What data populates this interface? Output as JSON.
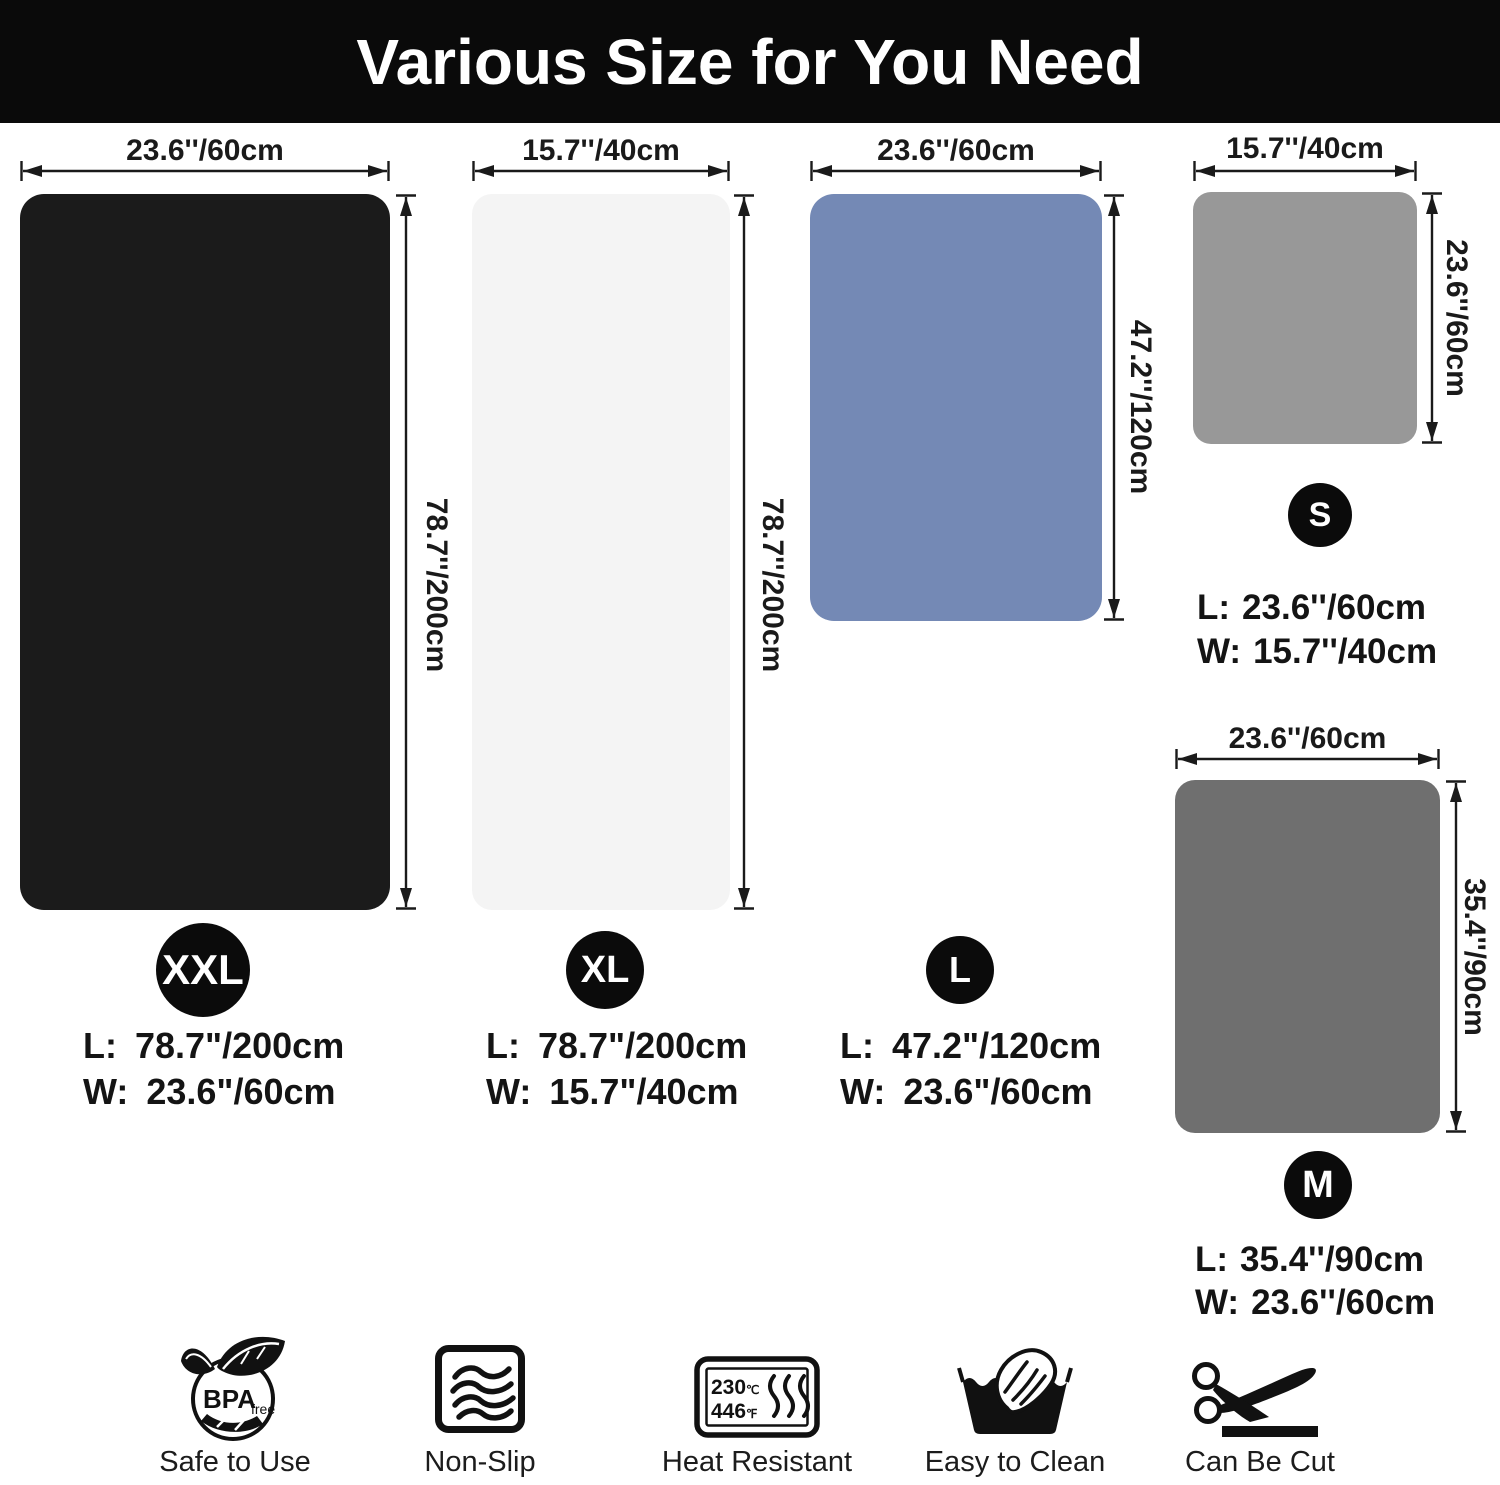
{
  "header": {
    "title": "Various Size for You Need"
  },
  "mats": {
    "xxl": {
      "badge": "XXL",
      "top_dim": "23.6''/60cm",
      "side_dim": "78.7''/200cm",
      "l_label": "L:",
      "l_value": "78.7\"/200cm",
      "w_label": "W:",
      "w_value": "23.6\"/60cm",
      "color": "#1b1b1b"
    },
    "xl": {
      "badge": "XL",
      "top_dim": "15.7''/40cm",
      "side_dim": "78.7''/200cm",
      "l_label": "L:",
      "l_value": "78.7\"/200cm",
      "w_label": "W:",
      "w_value": "15.7\"/40cm",
      "color": "#f4f4f4"
    },
    "l": {
      "badge": "L",
      "top_dim": "23.6''/60cm",
      "side_dim": "47.2''/120cm",
      "l_label": "L:",
      "l_value": "47.2\"/120cm",
      "w_label": "W:",
      "w_value": "23.6\"/60cm",
      "color": "#7489b5"
    },
    "s": {
      "badge": "S",
      "top_dim": "15.7''/40cm",
      "side_dim": "23.6''/60cm",
      "l_label": "L:",
      "l_value": "23.6''/60cm",
      "w_label": "W:",
      "w_value": "15.7''/40cm",
      "color": "#989898"
    },
    "m": {
      "badge": "M",
      "top_dim": "23.6''/60cm",
      "side_dim": "35.4''/90cm",
      "l_label": "L:",
      "l_value": "35.4''/90cm",
      "w_label": "W:",
      "w_value": "23.6''/60cm",
      "color": "#6f6f6f"
    }
  },
  "features": [
    {
      "icon": "bpa-free-icon",
      "label": "Safe to Use",
      "bpa_text": "BPA",
      "free_text": "free"
    },
    {
      "icon": "non-slip-icon",
      "label": "Non-Slip"
    },
    {
      "icon": "heat-resistant-icon",
      "label": "Heat Resistant",
      "temp_c": "230",
      "unit_c": "℃",
      "temp_f": "446",
      "unit_f": "℉"
    },
    {
      "icon": "easy-to-clean-icon",
      "label": "Easy to Clean"
    },
    {
      "icon": "can-be-cut-icon",
      "label": "Can Be Cut"
    }
  ],
  "colors": {
    "header_bg": "#0a0a0a",
    "line": "#1a1a1a"
  }
}
